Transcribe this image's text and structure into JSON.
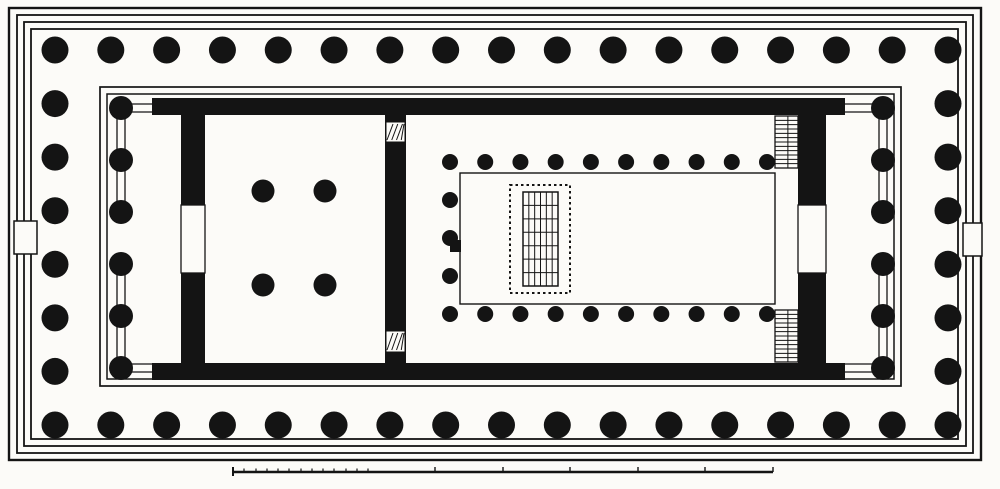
{
  "figure": {
    "subject": "classical-temple-floor-plan",
    "ink": "#141414",
    "paper": "#fcfbf8"
  },
  "canvas": {
    "w": 1000,
    "h": 489
  },
  "crepidoma": {
    "steps": [
      {
        "x": 9,
        "y": 8,
        "w": 972,
        "h": 452
      },
      {
        "x": 17,
        "y": 15,
        "w": 956,
        "h": 438
      },
      {
        "x": 24,
        "y": 22,
        "w": 942,
        "h": 424
      },
      {
        "x": 31,
        "y": 29,
        "w": 927,
        "h": 410
      }
    ],
    "tabs": [
      {
        "x": 14,
        "y": 221,
        "w": 23,
        "h": 33
      },
      {
        "x": 963,
        "y": 223,
        "w": 19,
        "h": 33
      }
    ]
  },
  "peristyle": {
    "radius": 13.5,
    "count_x": 17,
    "count_y": 8,
    "x1": 55,
    "x2": 948,
    "y1": 50,
    "y2": 425
  },
  "inner_platform": {
    "outer": {
      "x": 100,
      "y": 87,
      "w": 801,
      "h": 299
    },
    "inner": {
      "x": 107,
      "y": 94,
      "w": 787,
      "h": 285
    }
  },
  "walls": [
    {
      "name": "north-cella-wall",
      "x": 152,
      "y": 98,
      "w": 693,
      "h": 17
    },
    {
      "name": "south-cella-wall",
      "x": 152,
      "y": 363,
      "w": 693,
      "h": 17
    },
    {
      "name": "west-chamber-wall-upper",
      "x": 181,
      "y": 114,
      "w": 24,
      "h": 91
    },
    {
      "name": "west-chamber-wall-lower",
      "x": 181,
      "y": 273,
      "w": 24,
      "h": 91
    },
    {
      "name": "cross-wall",
      "x": 385,
      "y": 114,
      "w": 21,
      "h": 250
    },
    {
      "name": "east-wall-upper",
      "x": 798,
      "y": 114,
      "w": 28,
      "h": 91
    },
    {
      "name": "east-wall-lower",
      "x": 798,
      "y": 273,
      "w": 28,
      "h": 91
    }
  ],
  "doors": [
    {
      "name": "west-chamber-door",
      "x": 181,
      "y": 205,
      "w": 24,
      "h": 68
    },
    {
      "name": "east-great-door",
      "x": 798,
      "y": 205,
      "w": 28,
      "h": 68
    }
  ],
  "wall_hatches": [
    {
      "x": 386,
      "y": 122,
      "w": 19,
      "h": 20
    },
    {
      "x": 386,
      "y": 331,
      "w": 19,
      "h": 21
    }
  ],
  "west_porch": {
    "x": 121,
    "radius": 12,
    "ys": [
      108,
      160,
      212,
      264,
      316,
      368
    ],
    "open_gap_index": 2,
    "screen_dx": 4,
    "anta_x": 152
  },
  "east_porch": {
    "x": 883,
    "radius": 12,
    "ys": [
      108,
      160,
      212,
      264,
      316,
      368
    ],
    "open_gap_index": 2,
    "screen_dx": 4,
    "anta_x": 845
  },
  "west_chamber_columns": {
    "radius": 11.5,
    "points": [
      [
        263,
        191
      ],
      [
        325,
        191
      ],
      [
        263,
        285
      ],
      [
        325,
        285
      ]
    ]
  },
  "naos": {
    "colonnade": {
      "radius": 8,
      "x1": 450,
      "x2": 767,
      "count": 10,
      "y_top": 162,
      "y_bottom": 314,
      "return_x": 450,
      "return_ys": [
        200,
        238,
        276
      ]
    },
    "floor_line": {
      "x": 460,
      "y": 173,
      "w": 315,
      "h": 131
    },
    "axial_block": {
      "x": 450,
      "y": 240,
      "w": 11,
      "h": 12
    },
    "statue_base": {
      "dotted": {
        "x": 510,
        "y": 185,
        "w": 60,
        "h": 108
      },
      "grid": {
        "x": 523,
        "y": 192,
        "w": 35,
        "h": 94,
        "cols": 6,
        "rows": 7
      }
    },
    "stairs": [
      {
        "x": 775,
        "y": 116,
        "w": 23,
        "h": 52,
        "rungs": 12
      },
      {
        "x": 775,
        "y": 310,
        "w": 23,
        "h": 52,
        "rungs": 12
      }
    ]
  },
  "scale_bar": {
    "x1": 233,
    "x2": 773,
    "y": 472,
    "minor_ticks": [
      244,
      256,
      267,
      278,
      289,
      301,
      312,
      323,
      334,
      346,
      357,
      368
    ],
    "major_ticks": [
      435,
      503,
      570,
      638,
      705,
      773
    ]
  }
}
